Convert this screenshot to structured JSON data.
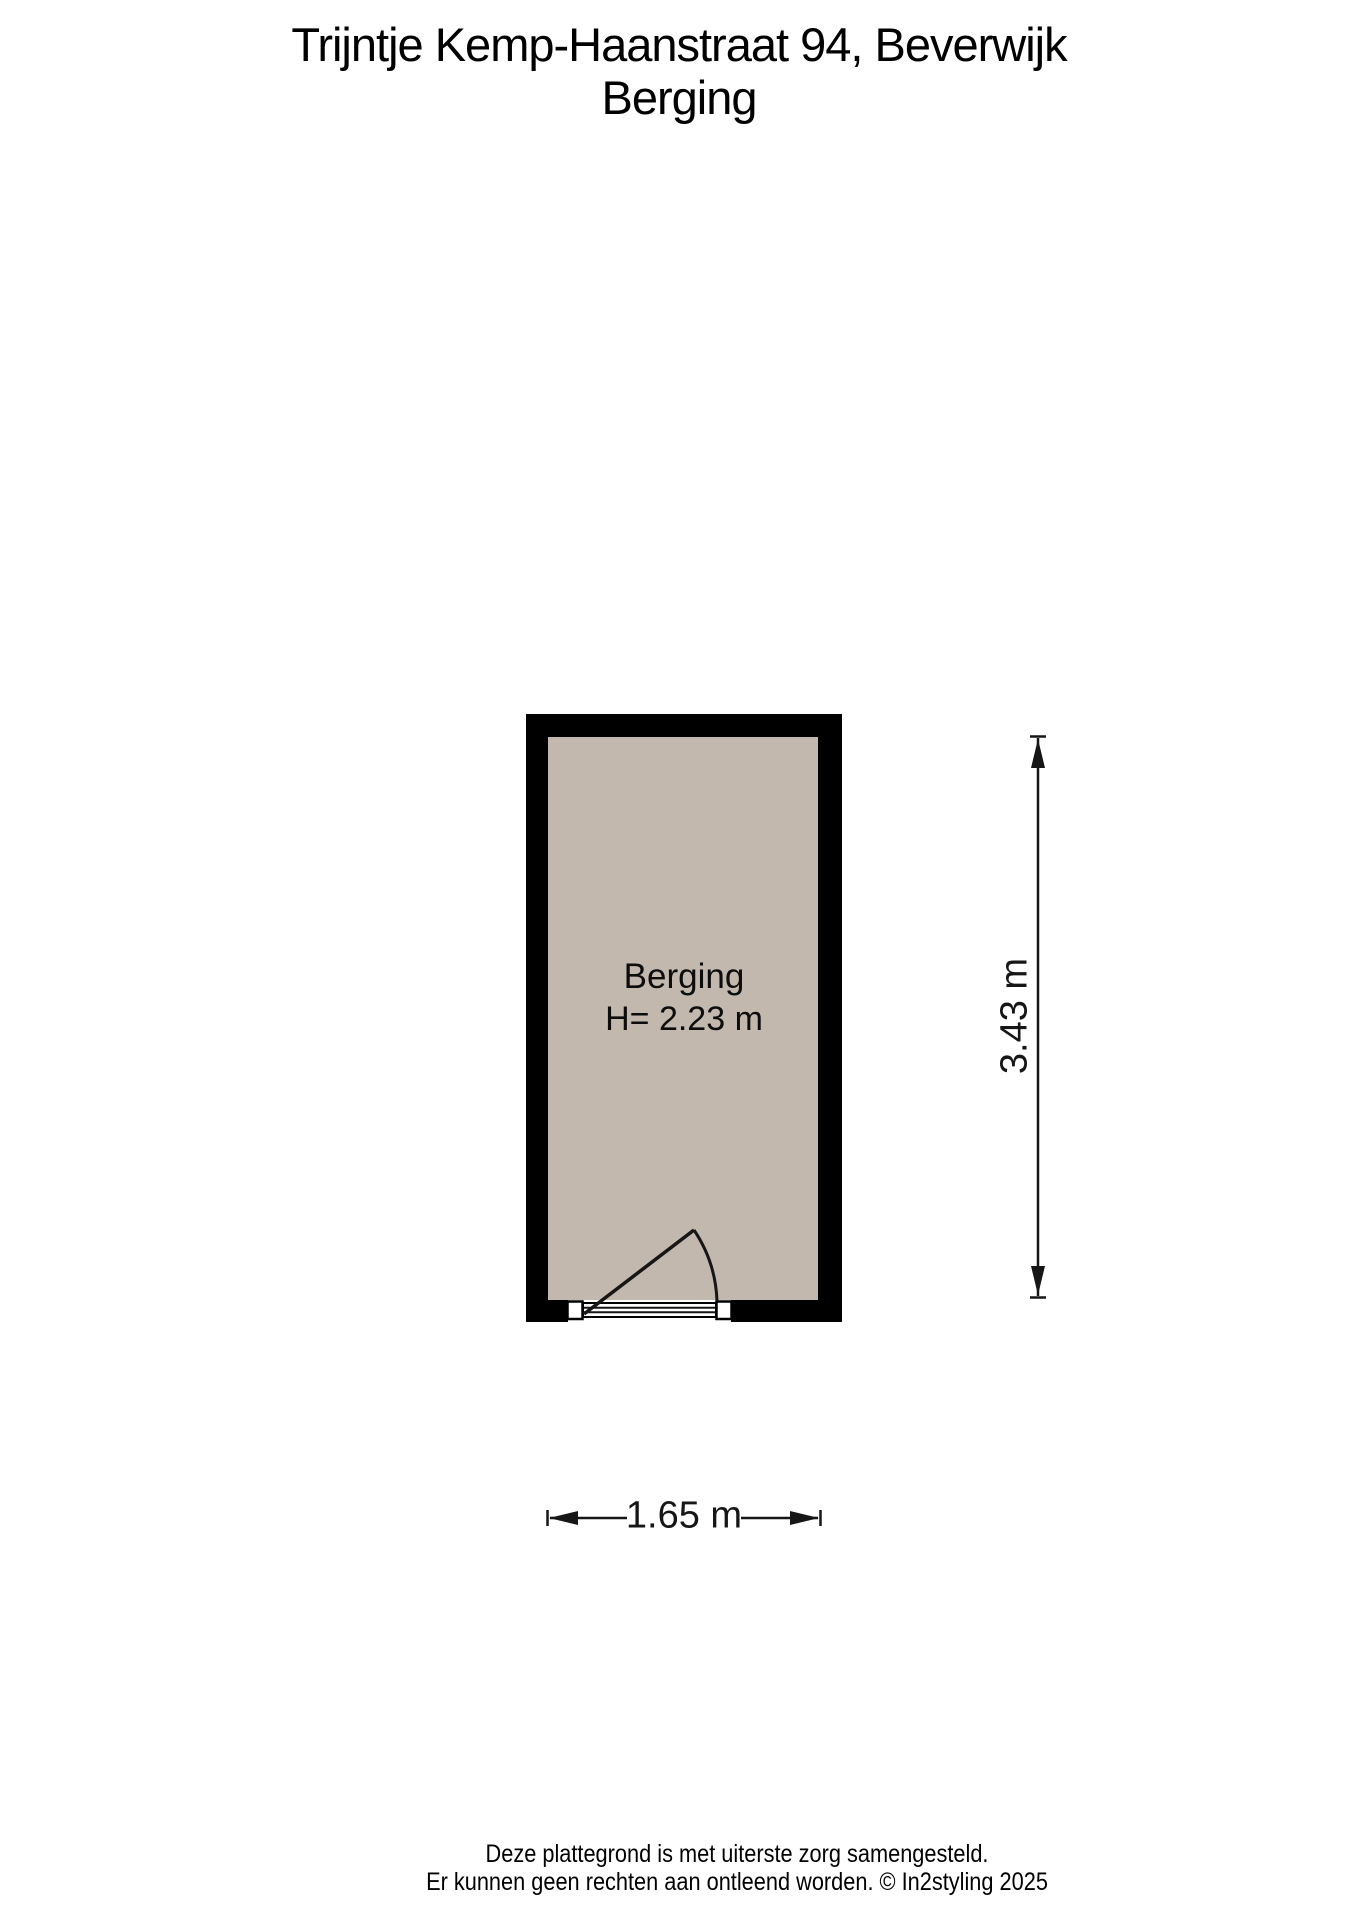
{
  "title": {
    "line1": "Trijntje Kemp-Haanstraat 94, Beverwijk",
    "line2": "Berging"
  },
  "room": {
    "name": "Berging",
    "height_label": "H= 2.23 m"
  },
  "dimensions": {
    "height_label": "3.43 m",
    "width_label": "1.65 m"
  },
  "footer": {
    "line1": "Deze plattegrond is met uiterste zorg samengesteld.",
    "line2": "Er kunnen geen rechten aan ontleend worden. © In2styling 2025"
  },
  "colors": {
    "wall": "#000000",
    "floor": "#c2b8ae",
    "line": "#161616"
  }
}
